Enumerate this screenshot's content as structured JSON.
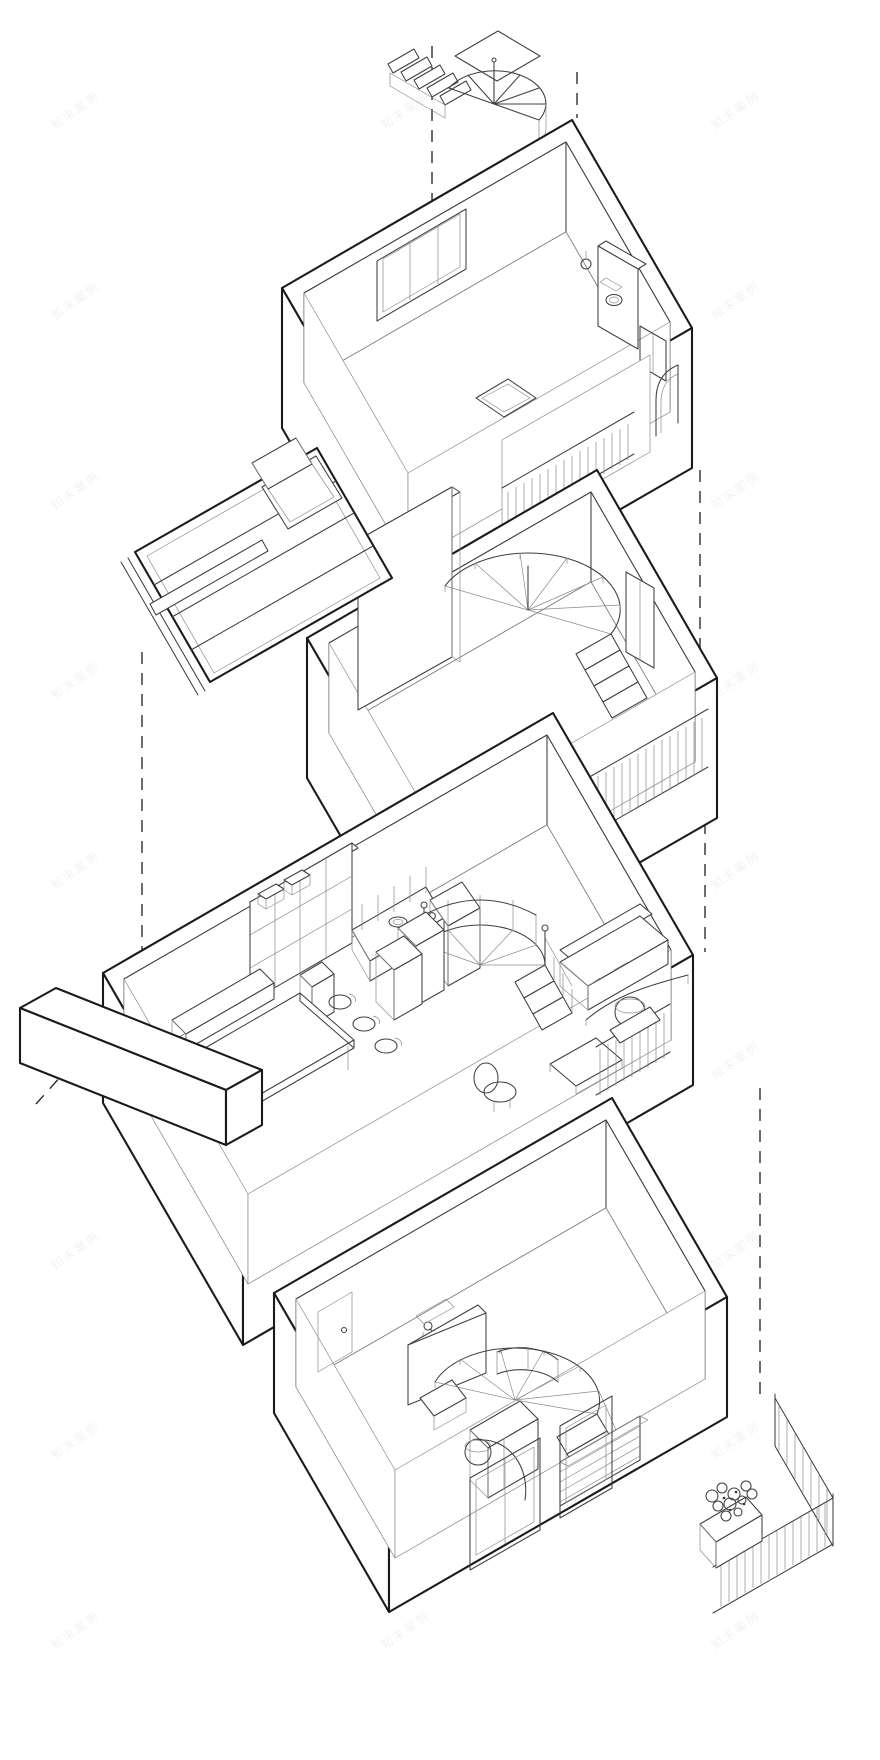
{
  "document": {
    "type": "axonometric exploded architectural drawing",
    "subject": "four-storey dwelling exploded into stacked floor levels linked by vertical dashed projection lines",
    "background_color": "#ffffff"
  },
  "palette": {
    "outline": "#1b1b1b",
    "medium_line": "#3f3f3f",
    "fine_line": "#8c8c8c",
    "dashed_line": "#262626",
    "paper": "#ffffff",
    "watermark": "#555555"
  },
  "watermark": {
    "text": "知末案例",
    "rotation_deg": -35,
    "opacity": 0.07
  },
  "projection": {
    "style": "dashed",
    "direction": "vertical"
  },
  "levels": [
    {
      "id": "roof-stair",
      "name": "roof spiral staircase",
      "features": [
        "straight flight",
        "winder fan steps",
        "rolled stringer"
      ]
    },
    {
      "id": "level-4",
      "name": "top floor - bedroom and bathroom",
      "features": [
        "strip window",
        "partition wall",
        "toilet and basin",
        "wardrobe",
        "floor hatch",
        "recessed balcony with slatted railing",
        "arched opening"
      ]
    },
    {
      "id": "level-3",
      "name": "third floor - room with winder stair",
      "features": [
        "spiral winder staircase",
        "stair shaft wall",
        "closet partitions",
        "window recess",
        "slatted shutter band"
      ]
    },
    {
      "id": "skylight-roof",
      "name": "detached glazed roof piece",
      "features": [
        "glazing panels",
        "opening skylight hatch",
        "gutter bar"
      ]
    },
    {
      "id": "level-2",
      "name": "second floor - kitchen, dining and living room",
      "features": [
        "staircase bookshelf",
        "kitchen counter with sink and hob",
        "backsplash",
        "fridge cabinet",
        "island cube",
        "bench",
        "dining table with chairs",
        "winder stair with balustrade",
        "tall cabinets",
        "sofa",
        "round side table",
        "arc floor lamp",
        "lounge chair",
        "coffee table",
        "slatted shutter with flower box"
      ]
    },
    {
      "id": "wall-slab",
      "name": "detached wall slab"
    },
    {
      "id": "level-1",
      "name": "ground floor - entry, shower room and terrace",
      "features": [
        "entry door",
        "shower head",
        "partition walls",
        "vanity",
        "wardrobe boxes",
        "winder stair with curved stringer",
        "louvred cabinet",
        "drum floor lamp",
        "window openings",
        "terrace railing",
        "planter with shrub"
      ]
    }
  ]
}
